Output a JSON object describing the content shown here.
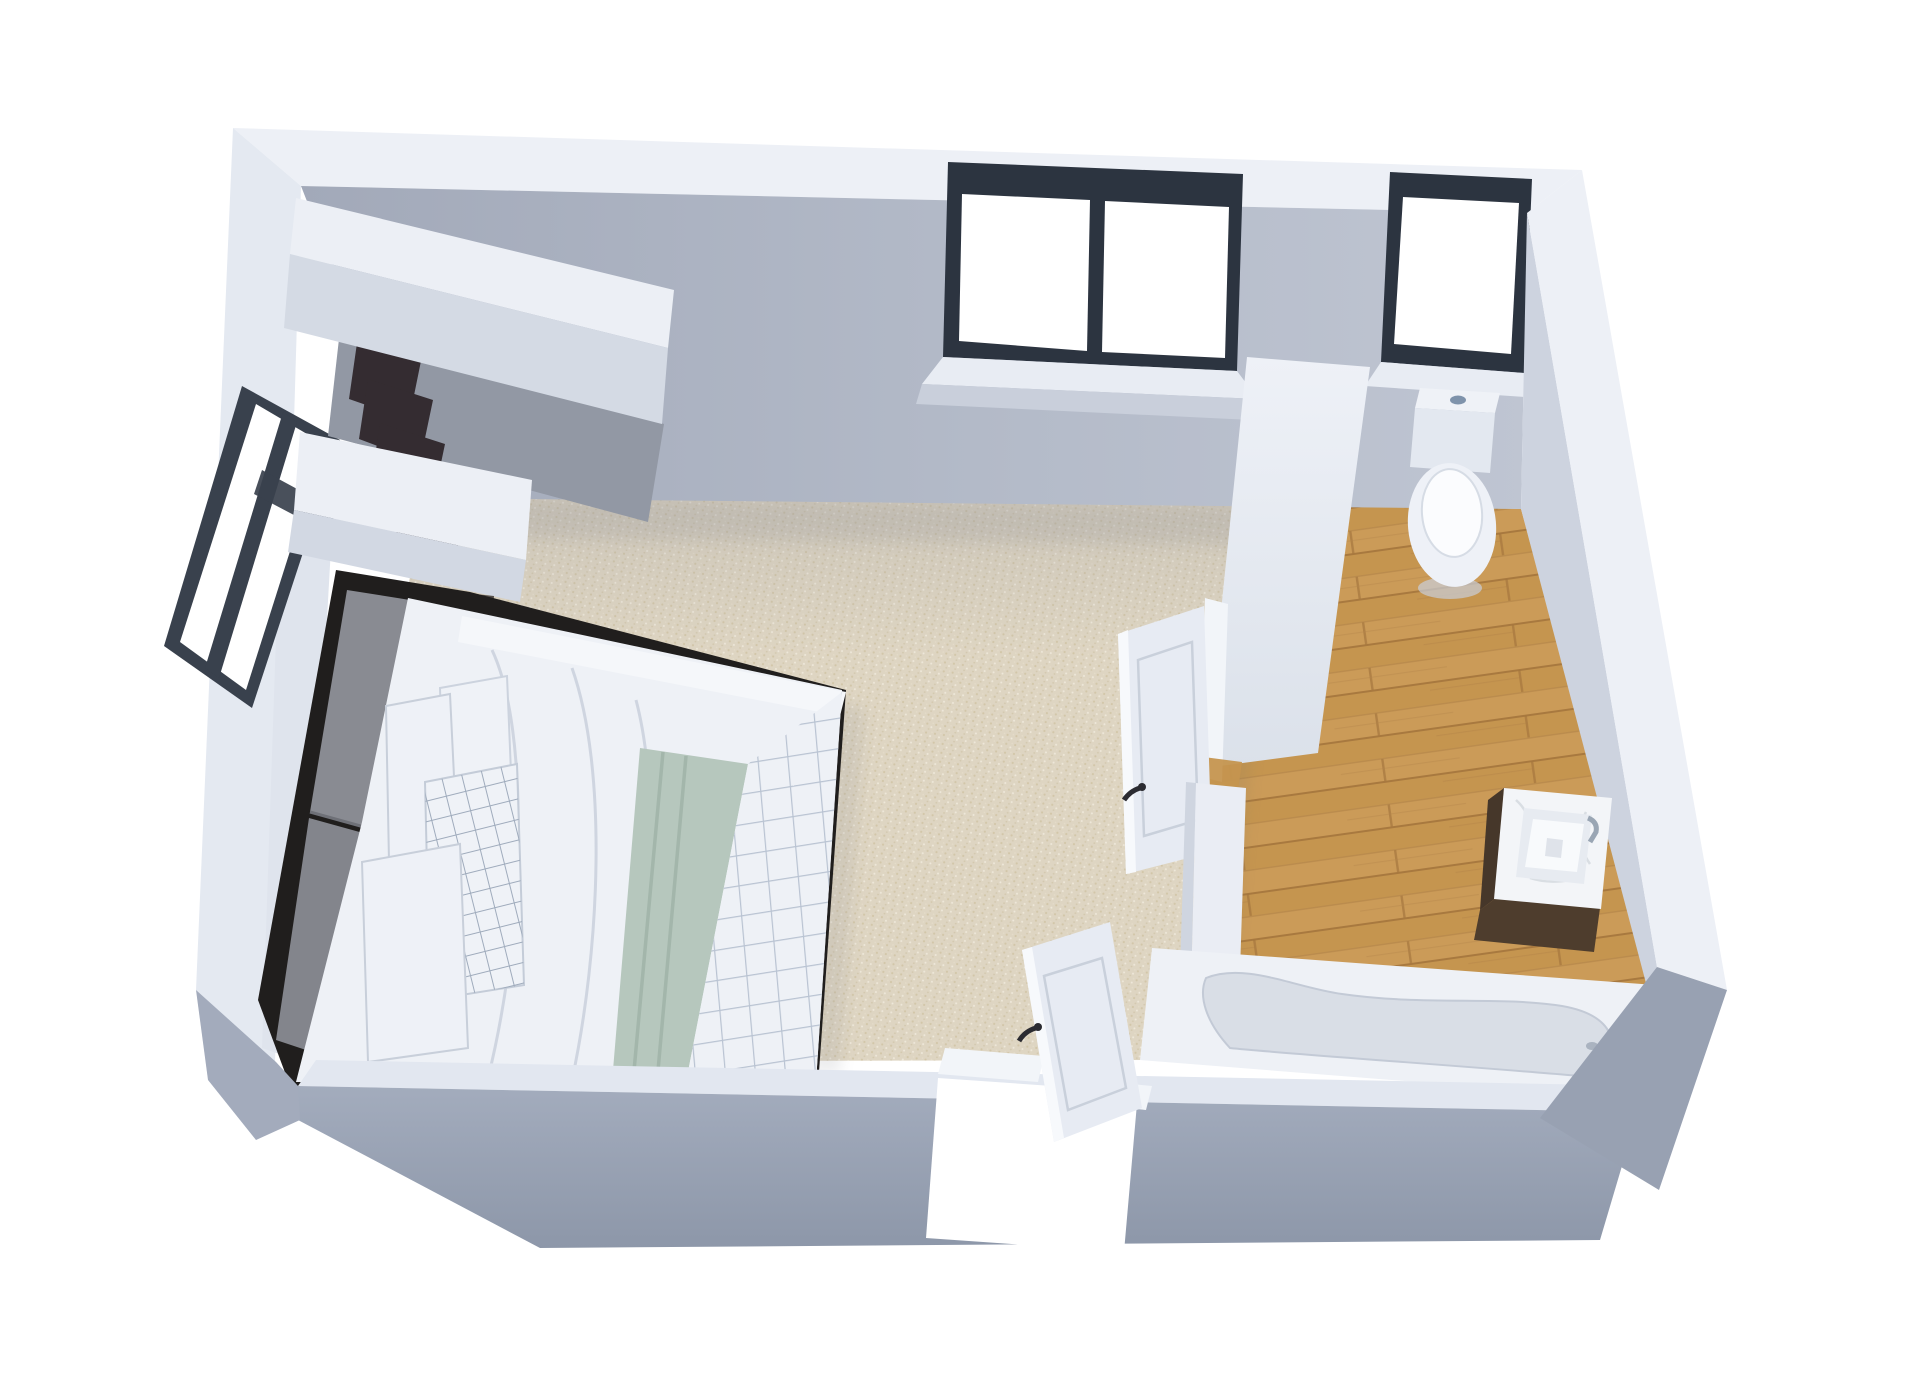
{
  "scene": {
    "kind": "3d-floorplan-render",
    "view": "isometric top-down dollhouse view",
    "rooms": [
      {
        "name": "bedroom",
        "floor": "beige speckled carpet"
      },
      {
        "name": "bathroom",
        "floor": "light oak plank wood"
      }
    ],
    "counts": {
      "windows": 3,
      "doors": 2
    },
    "items": [
      "closet-hanging-clothes",
      "left-wall-window",
      "double-bed",
      "headboard",
      "white-pillows",
      "grid-pillow",
      "sage-green-runner",
      "grid-duvet",
      "nightstand",
      "table-lamp",
      "picture-frame",
      "book",
      "bedroom-back-window",
      "bathroom-back-window",
      "partition-wall",
      "bathroom-door-open",
      "entry-door-open",
      "toilet",
      "vanity-sink",
      "faucet",
      "bathtub"
    ]
  },
  "palette": {
    "background": "#ffffff",
    "wall_top": "#edf0f6",
    "wall_light": "#cdd3df",
    "wall_mid": "#aeb5c4",
    "wall_front": "#98a1b2",
    "wall_outer": "#e4e9f1",
    "carpet": "#ded5c2",
    "wood": "#c5954f",
    "window_frame": "#2c3440",
    "window_glass": "#ffffff",
    "bedding_white": "#eef1f6",
    "sage_green": "#b6c7bd",
    "grid_line": "#b9c3d2",
    "headboard_gray": "#898b92",
    "bed_frame_dark": "#201e1d",
    "nightstand_top": "#56504b",
    "nightstand_front": "#3b3531",
    "clothes_dark": "#342c31",
    "clothes_gray": "#9aa2ae",
    "door_white": "#e7ebf3",
    "jamb_white": "#f2f5f9",
    "toilet_white": "#eff2f7",
    "tub_deck": "#eef1f6",
    "tub_basin": "#d9dee6",
    "vanity_wood": "#46372a",
    "counter_marble": "#f3f5f8",
    "chrome": "#9aa6b4"
  }
}
